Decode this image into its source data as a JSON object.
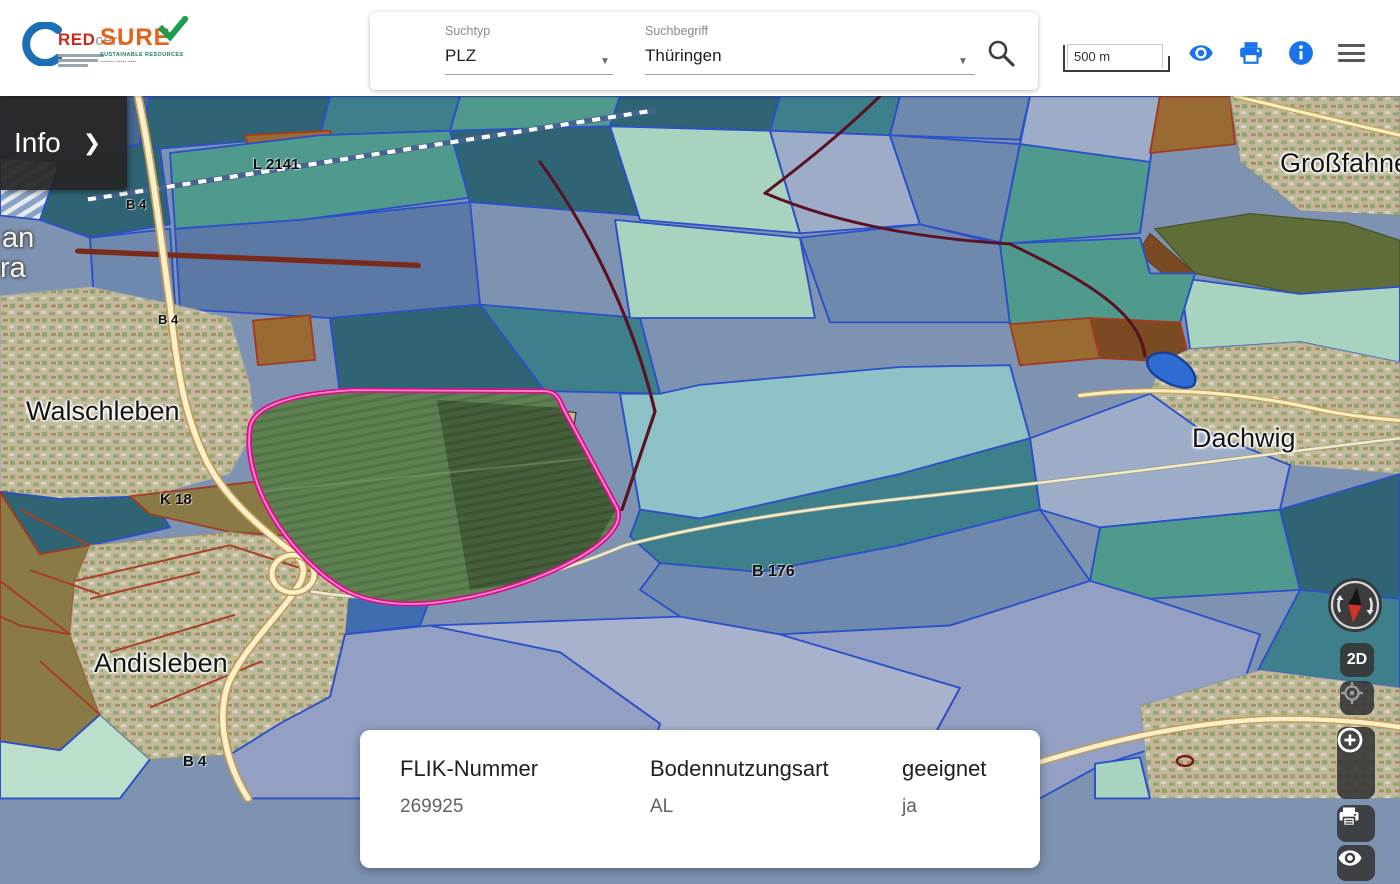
{
  "header": {
    "logos": {
      "redcert": {
        "red": "RED",
        "cert": "cert"
      },
      "sure": {
        "name": "SURE",
        "subtitle": "SUSTAINABLE RESOURCES"
      }
    },
    "search": {
      "suchtyp_label": "Suchtyp",
      "suchtyp_value": "PLZ",
      "suchbegriff_label": "Suchbegriff",
      "suchbegriff_value": "Thüringen"
    },
    "scale_label": "500 m"
  },
  "info_panel": {
    "label": "Info",
    "chevron": "❯"
  },
  "map": {
    "place_labels": [
      {
        "text": "Walschleben"
      },
      {
        "text": "Andisleben"
      },
      {
        "text": "Dachwig"
      },
      {
        "text": "Großfahner"
      },
      {
        "text": "an"
      },
      {
        "text": "ra"
      }
    ],
    "road_labels": [
      {
        "text": "L 2141"
      },
      {
        "text": "B 4"
      },
      {
        "text": "B 4"
      },
      {
        "text": "K 18"
      },
      {
        "text": "B 4"
      },
      {
        "text": "B 176"
      }
    ]
  },
  "map_controls": {
    "mode_2d": "2D"
  },
  "info_card": {
    "columns": [
      {
        "label": "FLIK-Nummer",
        "value": "269925"
      },
      {
        "label": "Bodennutzungsart",
        "value": "AL"
      },
      {
        "label": "geeignet",
        "value": "ja"
      }
    ]
  },
  "colors": {
    "accent_blue": "#1a73e8",
    "highlight_pink": "#df0d8b",
    "parcel_border": "#2b50c8",
    "panel_dark": "#262626"
  }
}
